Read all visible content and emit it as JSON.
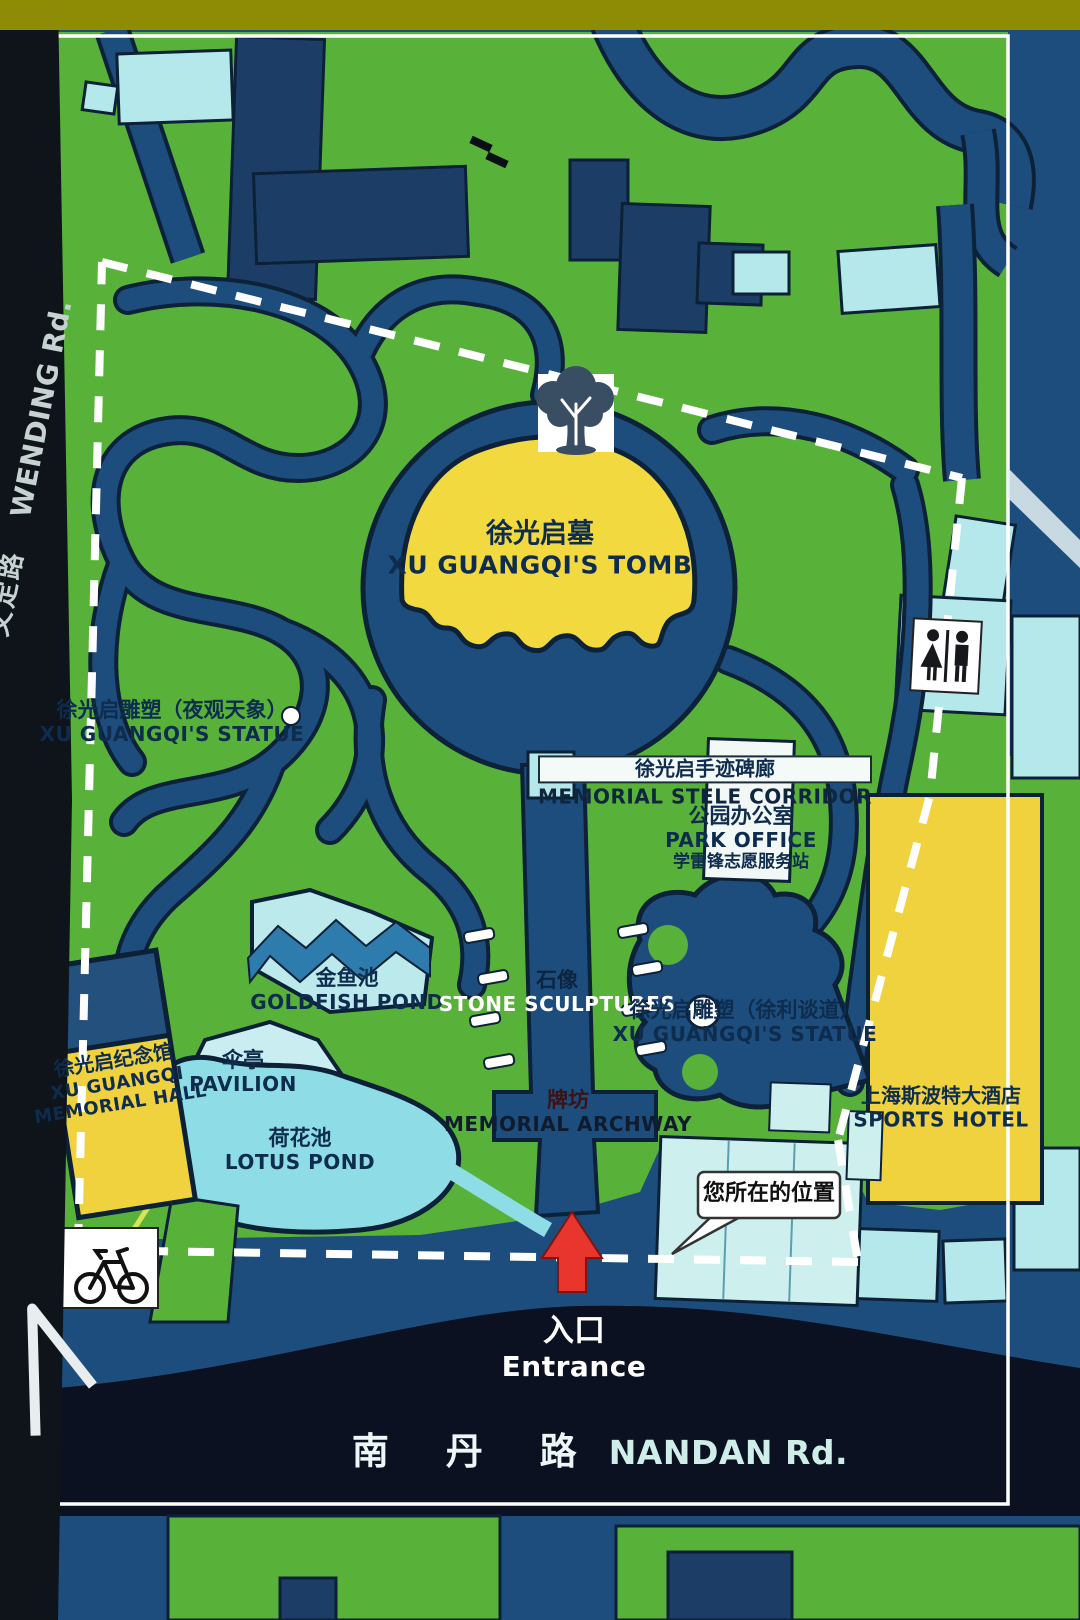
{
  "sign": {
    "type": "park-guide-map",
    "park": "Guangqi Park map sign"
  },
  "colors": {
    "park_green": "#58b23a",
    "water_navy": "#1d4d7d",
    "building_cyan": "#b5e8ea",
    "highlight_yellow": "#f2d93f",
    "arrow_red": "#e8352e",
    "boundary_white": "#ffffff",
    "frame_olive": "#8e8c05",
    "road_dark": "#0c1220"
  },
  "labels": {
    "wending_road": {
      "zh": "文定路",
      "en": "WENDING Rd."
    },
    "tomb": {
      "zh": "徐光启墓",
      "en": "XU GUANGQI'S TOMB"
    },
    "statue_night": {
      "zh": "徐光启雕塑（夜观天象）",
      "en": "XU GUANGQI'S STATUE"
    },
    "stele_corridor": {
      "zh": "徐光启手迹碑廊",
      "en": "MEMORIAL STELE CORRIDOR"
    },
    "park_office": {
      "zh": "公园办公室",
      "en": "PARK OFFICE",
      "line3": "学雷锋志愿服务站"
    },
    "goldfish_pond": {
      "zh": "金鱼池",
      "en": "GOLDFISH POND"
    },
    "stone_sculptures": {
      "zh": "石像",
      "en": "STONE SCULPTURES"
    },
    "statue_xuli": {
      "zh": "徐光启雕塑（徐利谈道）",
      "en": "XU GUANGQI'S STATUE"
    },
    "memorial_hall": {
      "zh": "徐光启纪念馆",
      "en1": "XU GUANGQI",
      "en2": "MEMORIAL HALL"
    },
    "pavilion": {
      "zh": "伞亭",
      "en": "PAVILION"
    },
    "lotus_pond": {
      "zh": "荷花池",
      "en": "LOTUS POND"
    },
    "archway": {
      "zh": "牌坊",
      "en": "MEMORIAL ARCHWAY"
    },
    "you_are_here": {
      "zh": "您所在的位置"
    },
    "sports_hotel": {
      "zh": "上海斯波特大酒店",
      "en": "SPORTS HOTEL"
    },
    "entrance": {
      "zh": "入口",
      "en": "Entrance"
    },
    "nandan_road": {
      "zh": "南 丹 路",
      "en": "NANDAN Rd."
    }
  },
  "icons": {
    "tree": "ancient-tree-icon",
    "restroom": "restroom-icon",
    "bicycle": "bicycle-parking-icon",
    "entrance_arrow": "entrance-arrow-icon",
    "you_are_here_marker": "you-are-here-bubble"
  }
}
